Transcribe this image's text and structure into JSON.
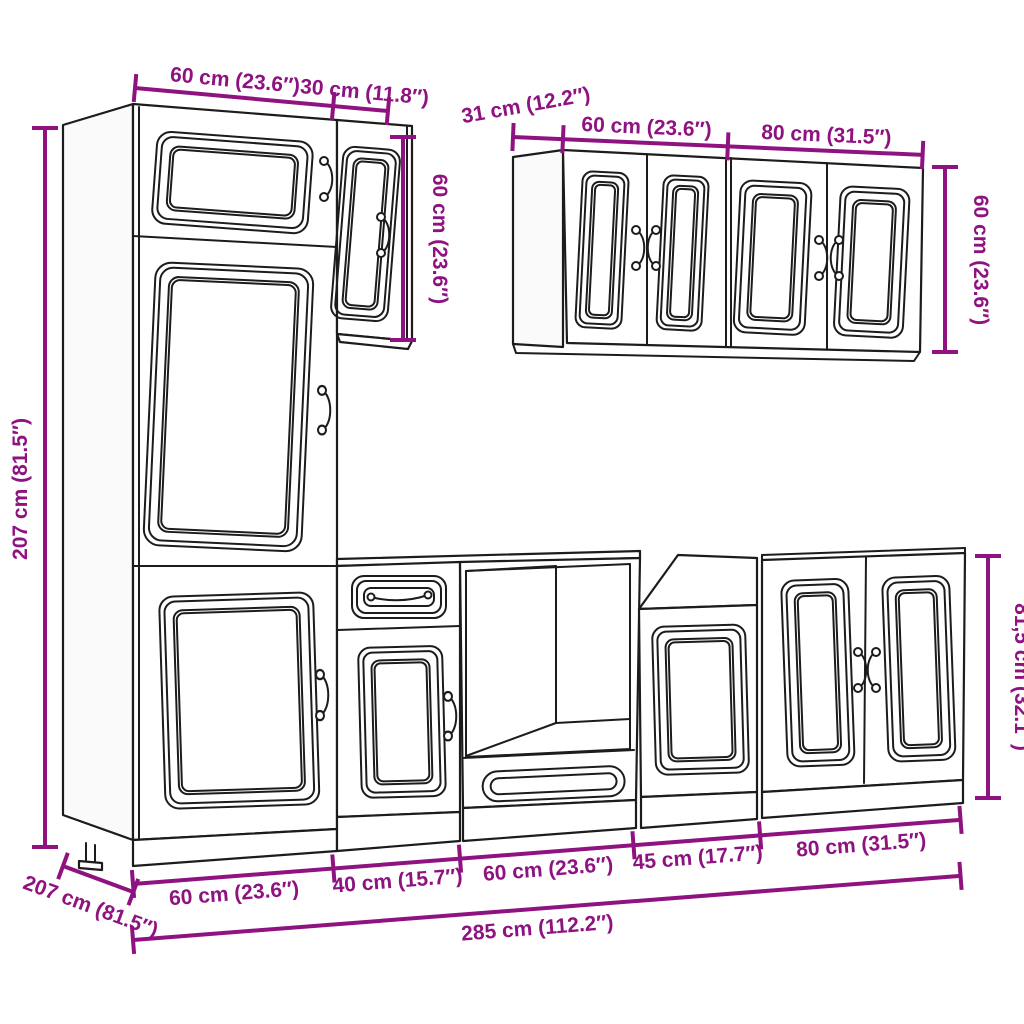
{
  "diagram": {
    "title": "kitchen-cabinet-set-dimension-drawing",
    "accent_color": "#8E1280",
    "line_color": "#1c1c1c",
    "background": "#ffffff"
  },
  "labels": {
    "top_tall_width": "60 cm (23.6″)",
    "top_small_width": "30 cm (11.8″)",
    "small_cab_height": "60 cm (23.6″)",
    "wall_depth": "31 cm (12.2″)",
    "wall_width_60": "60 cm (23.6″)",
    "wall_width_80": "80 cm (31.5″)",
    "wall_height": "60 cm (23.6″)",
    "tall_height": "207 cm (81.5″)",
    "tall_depth": "207 cm (81.5″)",
    "base_seg_1": "60 cm (23.6″)",
    "base_seg_2": "40 cm (15.7″)",
    "base_seg_3": "60 cm (23.6″)",
    "base_seg_4": "45 cm (17.7″)",
    "base_seg_5": "80 cm (31.5″)",
    "total_width": "285 cm (112.2″)",
    "base_height": "81,5 cm (32.1″)"
  }
}
